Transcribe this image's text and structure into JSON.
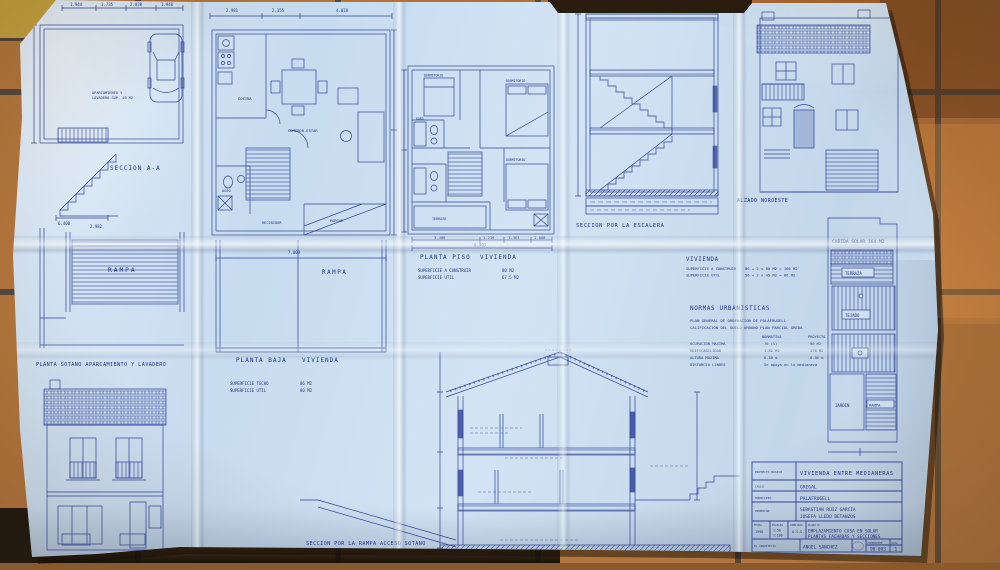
{
  "paper": {
    "sotano": {
      "plan_note1": "APARCAMIENTO Y",
      "plan_note2": "LAVADERO SUP. 40 M2",
      "dims_top": [
        "1.944",
        "1.735",
        "2.038",
        "1.948"
      ],
      "dim_a": "6.400",
      "dim_b": "2.982",
      "seccion_label": "SECCION  A-A",
      "rampa_label": "RAMPA",
      "plan_label": "PLANTA SOTANO APARCAMIENTO Y LAVADERO",
      "alzado_label": "ALZADO NORTE"
    },
    "planta_baja": {
      "dims_top": [
        "2.981",
        "2.155",
        "4.018"
      ],
      "rooms": {
        "cocina": "COCINA",
        "comedor": "COMEDOR-ESTAR",
        "aseo": "ASEO",
        "recibidor": "RECIBIDOR",
        "porche": "PORCHE"
      },
      "rampa_dim": "7.003",
      "rampa_label": "RAMPA",
      "label": "PLANTA BAJA",
      "label2": "VIVIENDA",
      "sup1": "SUPERFICIE TECHO",
      "sup1_val": "86  M2",
      "sup2": "SUPERFICIE UTIL",
      "sup2_val": "80  M2"
    },
    "planta_piso": {
      "rooms": {
        "dorm1": "DORMITORIO",
        "dorm2": "DORMITORIO",
        "dorm3": "DORMITORIO",
        "bano": "BAÑO",
        "terraza": "TERRAZA"
      },
      "dims_bottom": [
        "3.408",
        "1.218",
        "1.363",
        "1.008"
      ],
      "dim_total": "6.993",
      "label": "PLANTA PISO",
      "label2": "VIVIENDA",
      "sup1": "SUPERFICIE A CONSTRUIR",
      "sup1_val": "80  M2",
      "sup2": "SUPERFICIE UTIL",
      "sup2_val": "67.5 M2"
    },
    "escalera": {
      "label": "SECCION POR LA ESCALERA"
    },
    "vivienda": {
      "title": "VIVIENDA",
      "sup1": "SUPERFICIE A CONSTRUIR",
      "sup1_val": "86 + 2 x 80 M2 = 166 M2",
      "sup2": "SUPERFICIE UTIL",
      "sup2_val": "56 + 2 x 45 M2 =  86 M2"
    },
    "normas": {
      "title": "NORMAS URBANISTICAS",
      "line1": "PLAN GENERAL DE ORDENACION DE PALAFRUGELL",
      "line2": "CALIFICACION DEL SUELO   URBANO   PLAN PARCIAL  GREDA",
      "col_a": "NORMATIVA",
      "col_b": "PROYECTO",
      "r1k": "OCUPACION MAXIMA",
      "r1a": "70 (%)",
      "r1b": "90 M2",
      "r2k": "EDIFICABILIDAD",
      "r2a": "1.82 M2",
      "r2b": "176 M2",
      "r3k": "ALTURA MAXIMA",
      "r3a": "6.50 m",
      "r3b": "6.50 m",
      "r4k": "DISTANCIA LINDES",
      "r4a": "Se apoya en la medianera"
    },
    "seccion_rampa": {
      "label": "SECCION POR LA RAMPA ACCESO SOTANO"
    },
    "alzado_noroeste": {
      "label": "ALZADO NOROESTE"
    },
    "solar": {
      "title": "CABIDA SOLAR 164 M2",
      "terraza": "TERRAZA",
      "tejado": "TEJADO",
      "jardin": "JARDIN",
      "rampa": "RAMPA"
    },
    "titleblock": {
      "l_proyecto": "PROYECTO BASICO",
      "v_proyecto": "VIVIENDA ENTRE MEDIANERAS",
      "l_calle": "CALLE",
      "v_calle": "GREGAL",
      "l_municipio": "MUNICIPIO",
      "v_municipio": "PALAFRUGELL",
      "l_promotor": "PROMOTOR",
      "v_promotor1": "SEBASTIAN RUIZ GARCIA",
      "v_promotor2": "JOSEFA LLEDO BETANZOS",
      "l_fecha": "FECHA",
      "v_fecha": "1998",
      "l_escalas": "ESCALAS",
      "v_escalas1": "1:50",
      "v_escalas2": "1:100",
      "l_dibujado": "DIBUJADO",
      "v_dibujado": "A.S.S.",
      "l_plano": "PLANO Nº",
      "v_plano1": "EMPLAZAMIENTO CASA EN SOLAR",
      "v_plano2": "PLANTAS FACHADAS Y SECCIONES",
      "l_arquitecto": "EL ARQUITECTO",
      "v_arquitecto": "ANGEL SANCHEZ",
      "l_expediente": "EXPEDIENTE",
      "v_expediente": "98 003",
      "l_hoja": "HOJA",
      "v_hoja": "1"
    }
  }
}
